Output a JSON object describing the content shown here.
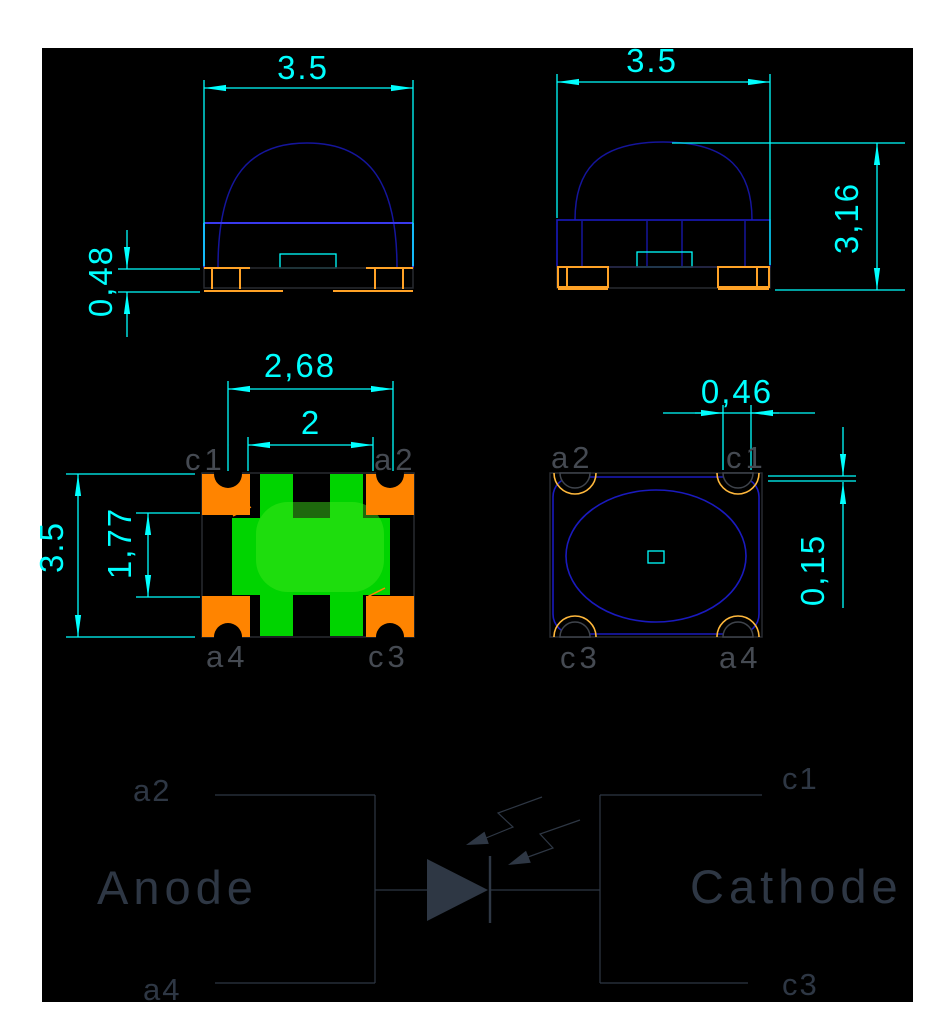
{
  "drawing_title": "smd-led-package-drawing",
  "colors": {
    "canvas_background": "#000000",
    "page_background": "#ffffff",
    "dimension_cyan": "#00ffff",
    "outline_blue": "#1a1abe",
    "bright_blue": "#3939ee",
    "pad_orange_fill": "#ff8400",
    "pad_orange_line": "#ffa226",
    "arc_orange": "#ffb83c",
    "die_green": "#00d400",
    "die_green_light": "#43e81c",
    "pin_label_gray": "#454a52",
    "schematic_gray": "#2e3744"
  },
  "front_view": {
    "width_dim": "3.5",
    "base_dim": "0,48"
  },
  "side_view": {
    "width_dim": "3.5",
    "height_dim": "3,16"
  },
  "bottom_view": {
    "span_dim": "2,68",
    "inner_dim": "2",
    "height_dim": "3.5",
    "center_dim": "1,77",
    "pin_top_left": "c1",
    "pin_top_right": "a2",
    "pin_bottom_left": "a4",
    "pin_bottom_right": "c3"
  },
  "top_view": {
    "notch_dim": "0,46",
    "edge_dim": "0,15",
    "pin_top_left": "a2",
    "pin_top_right": "c1",
    "pin_bottom_left": "c3",
    "pin_bottom_right": "a4"
  },
  "schematic": {
    "anode_label": "Anode",
    "cathode_label": "Cathode",
    "pin_anode_top": "a2",
    "pin_anode_bottom": "a4",
    "pin_cathode_top": "c1",
    "pin_cathode_bottom": "c3"
  }
}
